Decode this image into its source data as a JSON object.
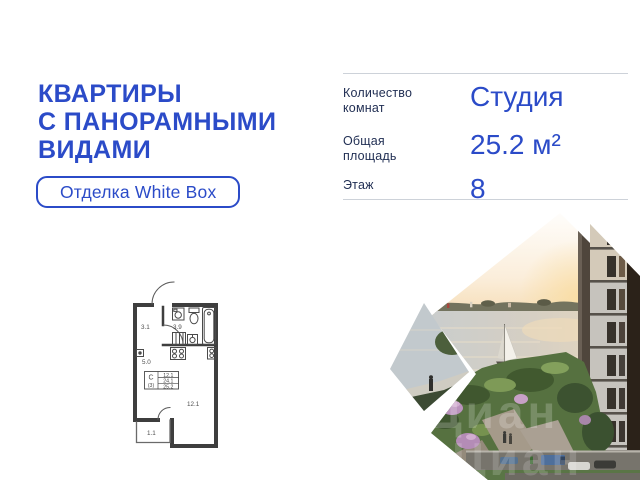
{
  "headline": {
    "lines": [
      "КВАРТИРЫ",
      "С ПАНОРАМНЫМИ",
      "ВИДАМИ"
    ],
    "color": "#2b4bc8"
  },
  "badge": {
    "label": "Отделка White Box"
  },
  "specs": {
    "rows": [
      {
        "label": "Количество комнат",
        "label_lines": [
          "Количество",
          "комнат"
        ],
        "value": "Студия"
      },
      {
        "label": "Общая площадь",
        "label_lines": [
          "Общая",
          "площадь"
        ],
        "value": "25.2 м²"
      },
      {
        "label": "Этаж",
        "label_lines": [
          "Этаж"
        ],
        "value": "8"
      }
    ]
  },
  "floor_plan": {
    "room_areas": {
      "hallway": "3.1",
      "bathroom": "3.9",
      "kitchen": "5.0",
      "living": "12.1",
      "balcony": "1.1"
    },
    "info_box": {
      "type": "С",
      "index": "(3)",
      "areas": [
        "12.1",
        "24.1",
        "25.2"
      ]
    }
  },
  "photo": {
    "watermark": "Циан"
  },
  "colors": {
    "accent": "#2b4bc8",
    "label_navy": "#1f2d52",
    "divider": "#cdd2d9",
    "plan_wall": "#3e3e3e"
  }
}
